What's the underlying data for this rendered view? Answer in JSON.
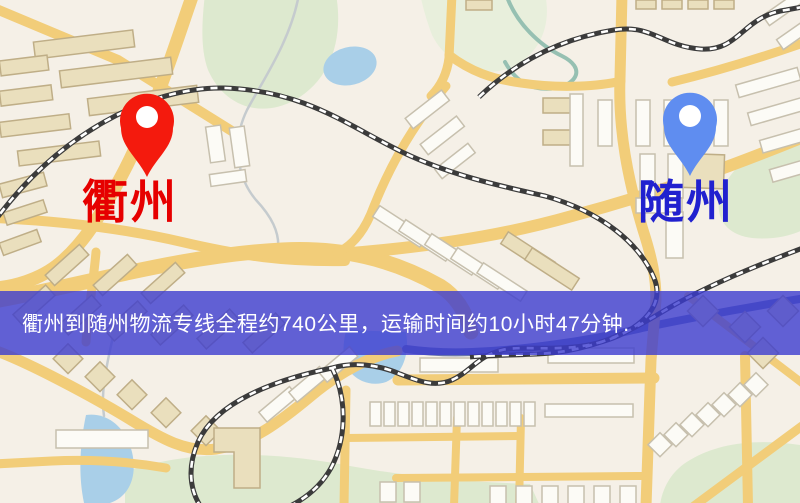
{
  "banner": {
    "text": "衢州到随州物流专线全程约740公里，运输时间约10小时47分钟.",
    "background_color": "#3c3cd0",
    "text_color": "#ffffff"
  },
  "route": {
    "origin_city": "衢州",
    "destination_city": "随州",
    "service_type": "物流专线",
    "distance_text": "约740公里",
    "duration_text": "约10小时47分钟"
  },
  "markers": {
    "origin": {
      "label": "衢州",
      "pin_color": "#f41a0d",
      "label_color": "#e60000"
    },
    "destination": {
      "label": "随州",
      "pin_color": "#5f8df0",
      "label_color": "#2121cf"
    }
  },
  "map_palette": {
    "background": "#f5f0e7",
    "road": "#f2cd79",
    "park": "#dde9cf",
    "park_pale": "#e8efdc",
    "water": "#a9cfe8",
    "river": "#6b77ab",
    "railway": "#3b3b3b",
    "railway_dash": "#ffffff",
    "building_tan": "#eadfbd",
    "building_tan_border": "#bfae87",
    "building_white": "#fcfbf6",
    "building_border": "#c7c0ae",
    "stream": "#c5cbce",
    "stream_green": "#96c0b2"
  }
}
